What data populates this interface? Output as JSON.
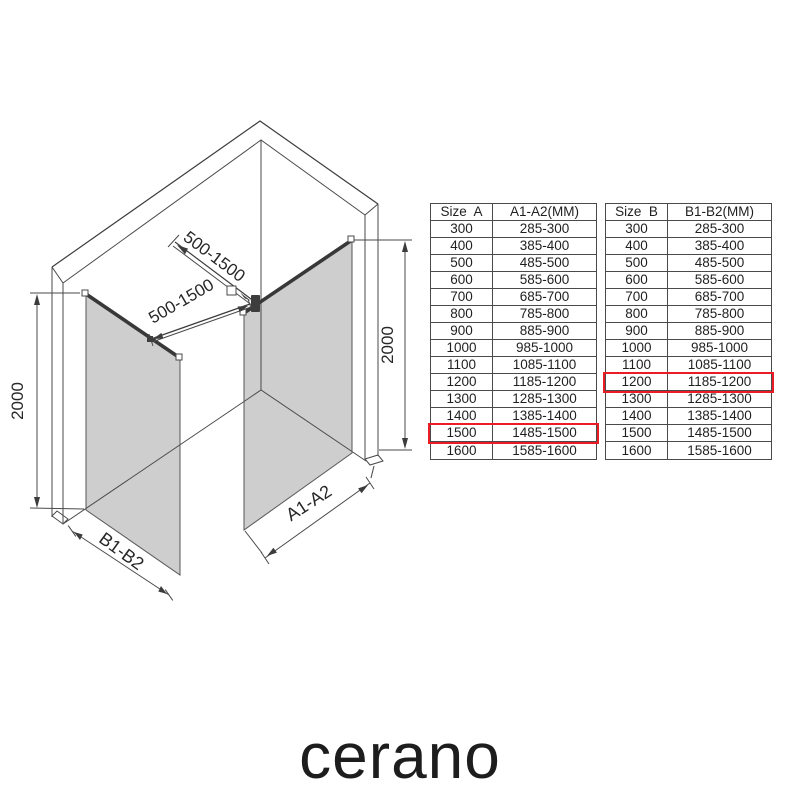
{
  "diagram": {
    "height_left_label": "2000",
    "height_right_label": "2000",
    "bar_upper_label": "500-1500",
    "bar_lower_label": "500-1500",
    "panel_a_label": "A1-A2",
    "panel_b_label": "B1-B2"
  },
  "tables": {
    "a": {
      "headers": [
        "Size  A",
        "A1-A2(MM)"
      ],
      "rows": [
        [
          "300",
          "285-300"
        ],
        [
          "400",
          "385-400"
        ],
        [
          "500",
          "485-500"
        ],
        [
          "600",
          "585-600"
        ],
        [
          "700",
          "685-700"
        ],
        [
          "800",
          "785-800"
        ],
        [
          "900",
          "885-900"
        ],
        [
          "1000",
          "985-1000"
        ],
        [
          "1100",
          "1085-1100"
        ],
        [
          "1200",
          "1185-1200"
        ],
        [
          "1300",
          "1285-1300"
        ],
        [
          "1400",
          "1385-1400"
        ],
        [
          "1500",
          "1485-1500"
        ],
        [
          "1600",
          "1585-1600"
        ]
      ],
      "highlight_row": 12
    },
    "b": {
      "headers": [
        "Size  B",
        "B1-B2(MM)"
      ],
      "rows": [
        [
          "300",
          "285-300"
        ],
        [
          "400",
          "385-400"
        ],
        [
          "500",
          "485-500"
        ],
        [
          "600",
          "585-600"
        ],
        [
          "700",
          "685-700"
        ],
        [
          "800",
          "785-800"
        ],
        [
          "900",
          "885-900"
        ],
        [
          "1000",
          "985-1000"
        ],
        [
          "1100",
          "1085-1100"
        ],
        [
          "1200",
          "1185-1200"
        ],
        [
          "1300",
          "1285-1300"
        ],
        [
          "1400",
          "1385-1400"
        ],
        [
          "1500",
          "1485-1500"
        ],
        [
          "1600",
          "1585-1600"
        ]
      ],
      "highlight_row": 9
    }
  },
  "colors": {
    "glass_fill": "#cecece",
    "line": "#4a4a4a",
    "highlight_red": "#ec1c24"
  },
  "logo": {
    "text": "cerano"
  }
}
